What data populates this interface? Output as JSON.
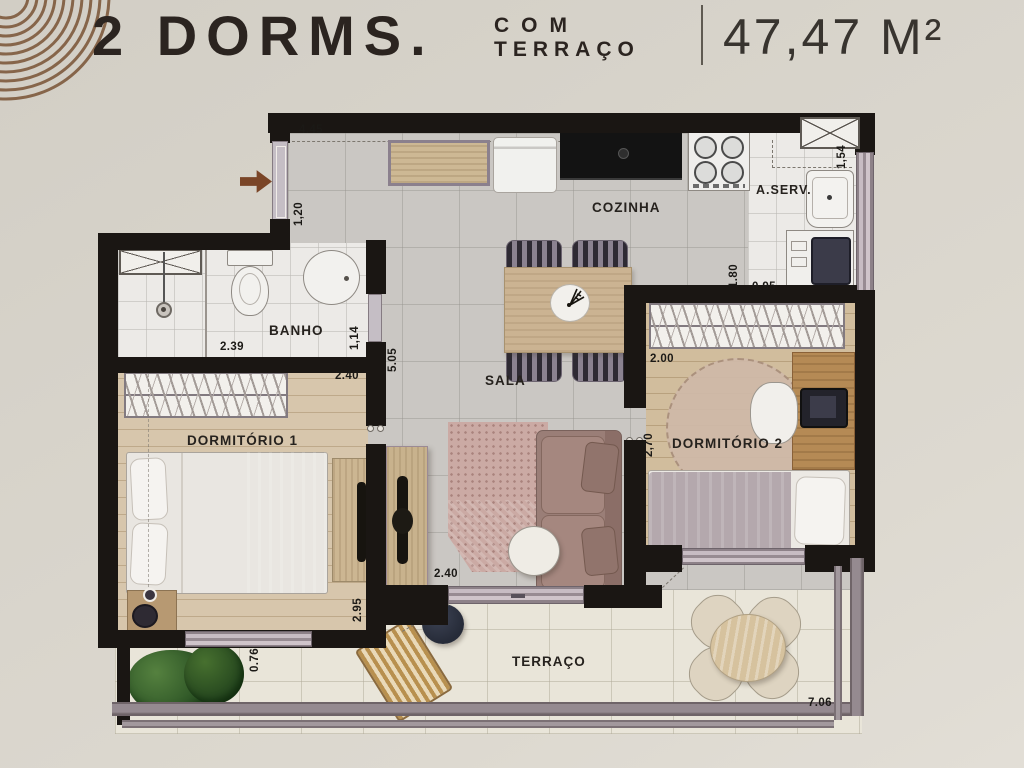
{
  "header": {
    "title": "2 DORMS.",
    "subtitle_top": "COM",
    "subtitle_bottom": "TERRAÇO",
    "area": "47,47 M²"
  },
  "rooms": {
    "cozinha": "COZINHA",
    "aserv": "A.SERV.",
    "banho": "BANHO",
    "sala": "SALA",
    "dorm1": "DORMITÓRIO 1",
    "dorm2": "DORMITÓRIO 2",
    "terraco": "TERRAÇO"
  },
  "dims": {
    "cozinha_largura": "4.45",
    "entrada": "1,20",
    "aserv_lado": "1,54",
    "aserv_fundo": "1.80",
    "aserv_frente": "0.95",
    "banho_largura": "2.39",
    "banho_porta": "1,14",
    "sala_fundo": "5.05",
    "dorm1_largura": "2.40",
    "dorm1_fundo": "2.95",
    "sala_largura": "2.40",
    "dorm2_largura": "2.00",
    "dorm2_fundo": "2,70",
    "terraco_lateral": "0.76",
    "terraco_frente": "7.06"
  },
  "colors": {
    "background": "#d8d4cb",
    "wall": "#1a1613",
    "accent_arc": "#86654a",
    "title_text": "#2b2420",
    "wood_floor": "#d5c3a8",
    "tile_floor": "#cac7c3",
    "railing": "#8d8187",
    "rug": "#c9a8a1",
    "sofa": "#9a7e77"
  }
}
